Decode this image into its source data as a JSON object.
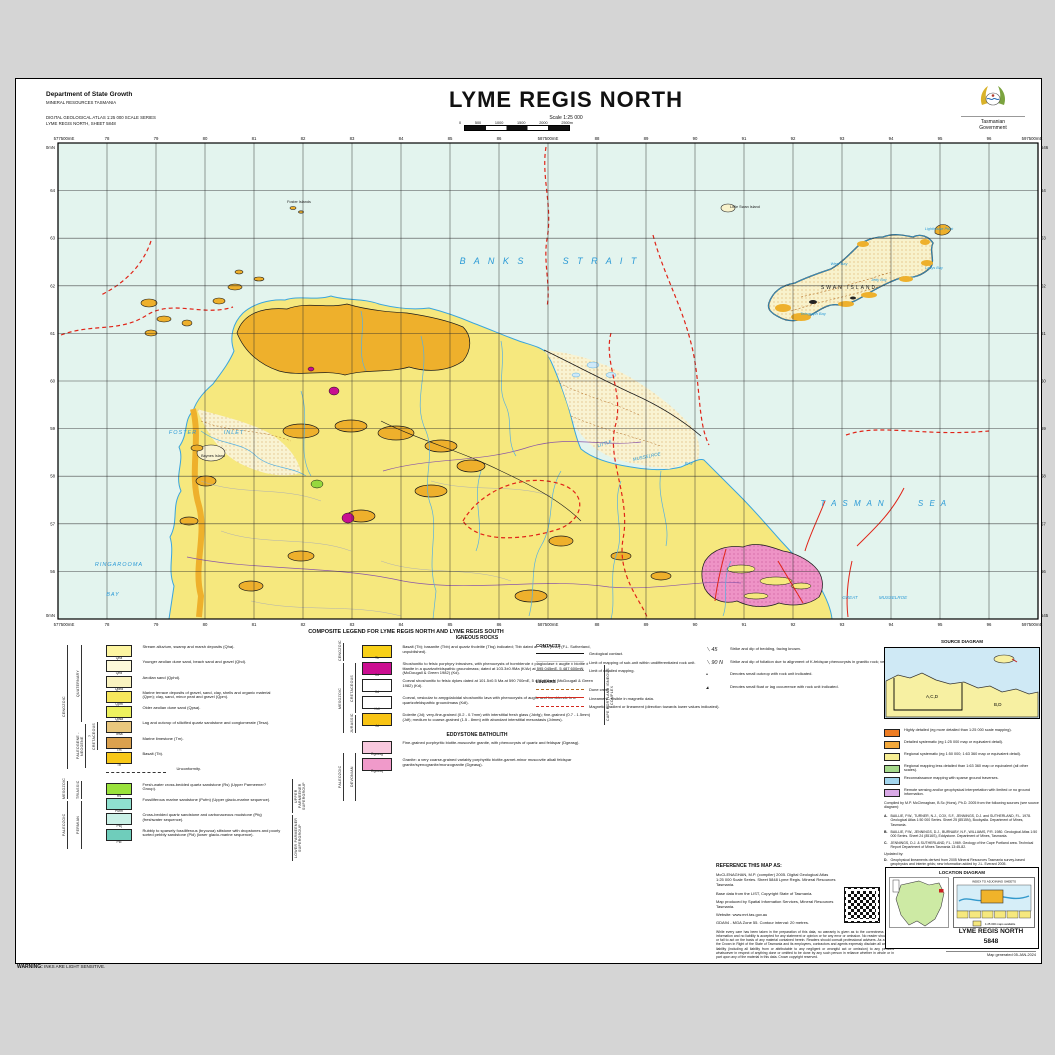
{
  "header": {
    "department": "Department of State Growth",
    "division": "MINERAL RESOURCES TASMANIA",
    "series_line1": "DIGITAL GEOLOGICAL ATLAS 1:25 000 SCALE SERIES",
    "series_line2": "LYME REGIS NORTH, SHEET 5848",
    "title": "LYME REGIS NORTH",
    "scale_label": "Scale 1:25 000",
    "scalebar_ticks": [
      "0",
      "500",
      "1000",
      "1500",
      "2000",
      "2500m"
    ],
    "logo_line1": "Tasmanian",
    "logo_line2": "Government"
  },
  "map": {
    "grid": {
      "eastings_top": [
        "78",
        "79",
        "80",
        "81",
        "82",
        "83",
        "84",
        "85",
        "86",
        "587500mE",
        "88",
        "89",
        "90",
        "91",
        "92",
        "93",
        "94",
        "95",
        "96"
      ],
      "eastings_bottom": [
        "78",
        "79",
        "80",
        "81",
        "82",
        "83",
        "84",
        "85",
        "86",
        "587500mE",
        "88",
        "89",
        "90",
        "91",
        "92",
        "93",
        "94",
        "95",
        "96"
      ],
      "northings_left": [
        "64",
        "63",
        "62",
        "61",
        "60",
        "59",
        "58",
        "57",
        "56"
      ],
      "northings_right": [
        "64",
        "63",
        "62",
        "61",
        "60",
        "59",
        "58",
        "57",
        "56"
      ],
      "corner_tl_e": "577500mE",
      "corner_tr_e": "597500mE",
      "corner_bl_e": "577500mE",
      "corner_br_e": "597500mE",
      "corner_tl_n": "5465000mN",
      "corner_bl_n": "5455000mN",
      "corner_tr_n": "5465000mN",
      "corner_br_n": "5455000mN"
    },
    "sea_labels": [
      {
        "text": "B A N K S",
        "x": 492,
        "y": 263,
        "s": 9,
        "sp": 3
      },
      {
        "text": "S T R A I T",
        "x": 600,
        "y": 263,
        "s": 9,
        "sp": 3
      },
      {
        "text": "T A S M A N",
        "x": 852,
        "y": 505,
        "s": 8,
        "sp": 2
      },
      {
        "text": "S E A",
        "x": 932,
        "y": 505,
        "s": 8,
        "sp": 2
      },
      {
        "text": "FOSTER",
        "x": 182,
        "y": 433,
        "s": 5.5,
        "sp": 1
      },
      {
        "text": "INLET",
        "x": 233,
        "y": 433,
        "s": 5.5,
        "sp": 1
      },
      {
        "text": "RINGAROOMA",
        "x": 118,
        "y": 565,
        "s": 5.5,
        "sp": 1
      },
      {
        "text": "BAY",
        "x": 112,
        "y": 595,
        "s": 5.5,
        "sp": 1
      },
      {
        "text": "LITTLE",
        "x": 604,
        "y": 444,
        "s": 4.5,
        "r": -18
      },
      {
        "text": "MUSSELROE",
        "x": 646,
        "y": 457,
        "s": 4.5,
        "r": -12
      },
      {
        "text": "BAY",
        "x": 688,
        "y": 464,
        "s": 4.5
      },
      {
        "text": "GREAT",
        "x": 849,
        "y": 598,
        "s": 4.5
      },
      {
        "text": "MUSSELROE",
        "x": 892,
        "y": 598,
        "s": 4.5
      },
      {
        "text": "West Bay",
        "x": 838,
        "y": 264,
        "s": 4
      },
      {
        "text": "Telegraph Bay",
        "x": 812,
        "y": 314,
        "s": 4
      },
      {
        "text": "Lighthouse Point",
        "x": 938,
        "y": 229,
        "s": 3.8
      },
      {
        "text": "Ladys Bay",
        "x": 933,
        "y": 268,
        "s": 3.8
      },
      {
        "text": "Jetty Bay",
        "x": 878,
        "y": 280,
        "s": 3.8
      }
    ],
    "place_labels": [
      {
        "text": "SWAN ISLAND",
        "x": 848,
        "y": 288,
        "s": 5,
        "sp": 2
      },
      {
        "text": "Baynes Island",
        "x": 212,
        "y": 456,
        "s": 3.8
      },
      {
        "text": "Little Swan Island",
        "x": 744,
        "y": 207,
        "s": 3.8
      },
      {
        "text": "Foster Islands",
        "x": 298,
        "y": 202,
        "s": 3.8
      }
    ]
  },
  "legend": {
    "title": "COMPOSITE LEGEND FOR LYME REGIS NORTH AND LYME REGIS SOUTH",
    "eras": {
      "cenozoic": "CENOZOIC",
      "mesozoic": "MESOZOIC",
      "paleozoic": "PALEOZOIC",
      "quaternary": "QUATERNARY",
      "holocene": "HOLOCENE",
      "pleistocene": "PLEISTOCENE",
      "paleogene_neogene": "PALEOGENE - NEOGENE",
      "cretaceous_q": "?CRETACEOUS",
      "triassic": "TRIASSIC",
      "permian": "PERMIAN",
      "upper_parmeener": "UPPER PARMEENER SUPERGROUP",
      "lower_parmeener": "LOWER PARMEENER SUPERGROUP",
      "cretaceous": "CRETACEOUS",
      "jurassic": "JURASSIC",
      "devonian": "DEVONIAN",
      "cape_portland": "CAPE PORTLAND IGNEOUS COMPLEX"
    },
    "left_units": [
      {
        "code": "Qha",
        "color": "#fdf5a0",
        "label": "Stream alluvium, swamp and marsh deposits (Qha)."
      },
      {
        "code": "Qhd",
        "color": "#fdf9d9",
        "pattern": "dots-sand",
        "label": "Younger aeolian dune sand, beach sand and gravel (Qhd)."
      },
      {
        "code": "Qphd",
        "color": "#faf3c0",
        "pattern": "dots-sand",
        "label": "Aeolian sand (Qphd)."
      },
      {
        "code": "Qpm",
        "color": "#f7e75c",
        "label": "Marine terrace deposits of gravel, sand, clay, shells and organic material (Qpm); clay, sand, minor peat and gravel (Qpm)."
      },
      {
        "code": "Qpsa",
        "color": "#eef25e",
        "pattern": "dots-sand",
        "label": "Older aeolian dune sand (Qpsa)."
      },
      {
        "code": "Tesa",
        "color": "#e9c77d",
        "label": "Lag and outcrop of silicified quartz sandstone and conglomerate (Tesa)."
      },
      {
        "code": "Tm",
        "color": "#dba14e",
        "label": "Marine limestone (Tm)."
      },
      {
        "code": "Tb",
        "color": "#f8c818",
        "label": "Basalt (Tb)."
      },
      {
        "code": "",
        "pattern": "unconf",
        "label": "Unconformity."
      },
      {
        "code": "Rs",
        "color": "#9ae23c",
        "label": "Fresh-water cross-bedded quartz sandstone (Rs) (Upper Parmeener? Group)."
      },
      {
        "code": "Pufm",
        "color": "#8fe0cf",
        "label": "Fossiliferous marine sandstone (Pufm) (Upper glacio-marine sequence)."
      },
      {
        "code": "Pfq",
        "color": "#c9f0e6",
        "label": "Cross-bedded quartz sandstone and carbonaceous mudstone (Pfq) (freshwater sequence)."
      },
      {
        "code": "Pld",
        "color": "#6fcdbb",
        "label": "Rubbly to sparsely fossiliferous (bryozoa) siltstone with dropstones and poorly sorted pebbly sandstone (Pld) (lower glacio-marine sequence)."
      }
    ],
    "igneous_title": "IGNEOUS ROCKS",
    "igneous_units": [
      {
        "code": "Tb",
        "color": "#f8d018",
        "label": "Basalt (Tb); basanite (Tbb) and quartz tholeiite (Tbq) indicated; Tbb dated at ~1Ma (K/Ar) (F.L. Sutherland, unpublished)."
      },
      {
        "code": "Kd",
        "color": "#cb0e91",
        "label": "Shoshonitic to felsic porphyry intrusives, with phenocrysts of hornblende ± plagioclase ± augite ± biotite ± titanite in a quartzofeldspathic groundmass; dated at 103.3±0.9Ma (K/Ar) at 595 045mE, 5 487 600mN (McDougall & Green 1982) (Kd)."
      },
      {
        "code": "Kd",
        "color": "#ffffff",
        "pattern": "stripes-mag",
        "label": "Coeval shoshonitic to felsic dykes dated at 101.5±0.5 Ma at 590 700mE, 5 487 400mN (McDougall & Green 1982) (Kd)."
      },
      {
        "code": "Kdl",
        "color": "#ffffff",
        "pattern": "stripes-pink",
        "label": "Coeval, vesicular to amygdaloidal shoshonitic lava with phenocrysts of augite and hornblende in a quartzofeldspathic groundmass (Kdl)."
      },
      {
        "code": "Jd",
        "color": "#f8c414",
        "label": "Dolerite (Jd); very-fine-grained (0.2 - 0.7mm) with interstitial fresh glass (Jdvfg); fine-grained (0.7 - 1.5mm) (Jdf); medium to coarse-grained (1.5 - 8mm) with abundant interstitial mesostasis (Jdmes)."
      }
    ],
    "batholith_title": "EDDYSTONE BATHOLITH",
    "batholith_units": [
      {
        "code": "Dgeasg",
        "color": "#f8c8de",
        "pattern": "dots-pink",
        "label": "Fine-grained porphyritic biotite-muscovite granite, with phenocrysts of quartz and feldspar (Dgeasg)."
      },
      {
        "code": "Dgeasq",
        "color": "#f09aca",
        "pattern": "dots-pink",
        "label": "Granite: a very coarse-grained variably porphyritic biotite-garnet-minor muscovite alkali feldspar granite/syenogranite/monzogranite (Dgeasq)."
      }
    ],
    "contacts_title": "CONTACTS",
    "contacts": [
      {
        "style": "ls-contact",
        "label": "Geological contact."
      },
      {
        "style": "ls-limit",
        "label": "Limit of mapping of sub-unit within undifferentiated rock unit."
      },
      {
        "style": "ls-detail",
        "label": "Limit of detailed mapping."
      }
    ],
    "linears_title": "LINEARS",
    "linears": [
      {
        "style": "ls-dune",
        "label": "Dune crest."
      },
      {
        "style": "ls-mag",
        "label": "Lineament - visible in magnetic data."
      },
      {
        "style": "ls-maggrad",
        "label": "Magnetic gradient or lineament (direction towards lower values indicated)."
      }
    ],
    "symbols": [
      {
        "glyph": "⟍ 45",
        "label": "Strike and dip of bedding, facing known."
      },
      {
        "glyph": "⟍ 90 N",
        "label": "Strike and dip of foliation due to alignment of K-feldspar phenocrysts in granitic rock; vertical."
      },
      {
        "glyph": "•",
        "label": "Denotes small outcrop with rock unit indicated."
      },
      {
        "glyph": "▴",
        "label": "Denotes small float or lag occurrence with rock unit indicated."
      }
    ]
  },
  "source_diagram": {
    "title": "SOURCE DIAGRAM",
    "region_a": "A,C,D",
    "region_b": "B,D",
    "legend": [
      {
        "color": "#ee7d23",
        "label": "Highly detailed (eg more detailed than 1:25 000 scale mapping)."
      },
      {
        "color": "#f3a93c",
        "label": "Detailed systematic (eg 1:25 000 map or equivalent detail)."
      },
      {
        "color": "#f7ee93",
        "label": "Regional systematic (eg 1:50 000; 1:63 360 map or equivalent detail)."
      },
      {
        "color": "#a5d98b",
        "label": "Regional mapping less detailed than 1:63 360 map or equivalent (all other scales)."
      },
      {
        "color": "#a3d6ee",
        "label": "Reconnaissance mapping with sparse ground traverses."
      },
      {
        "color": "#d9a9e6",
        "label": "Remote sensing and/or geophysical interpretation with limited or no ground information."
      }
    ],
    "compiled": "Compiled by M.P. McClenaghan, B.Sc (Hons), Ph.D. 2005 from the following sources (see source diagram):",
    "sources": [
      {
        "id": "A.",
        "text": "BAILLIE, P.W., TURNER, N.J., COX, S.F., JENNINGS, D.J. and SUTHERLAND, F.L. 1978. Geological Atlas 1:50 000 Series. Sheet 25 (8515N), Boobyalla. Department of Mines, Tasmania."
      },
      {
        "id": "B.",
        "text": "BAILLIE, P.W., JENNINGS, D.J., BURNABY, N.F., WILLIAMS, P.R. 1980. Geological Atlas 1:50 000 Series. Sheet 24 (8516S), Eddystone. Department of Mines, Tasmania."
      },
      {
        "id": "C.",
        "text": "JENNINGS, D.J. & SUTHERLAND, F.L. 1969. Geology of the Cape Portland area. Technical Report Department of Mines Tasmania 13:45-82."
      }
    ],
    "updated_label": "Updated by:",
    "updated": [
      {
        "id": "D.",
        "text": "Geophysical lineaments derived from 2005 Mineral Resources Tasmania survey-based geophysics and interim grids; new information added by J.L. Everard 2005."
      }
    ]
  },
  "reference": {
    "heading": "REFERENCE THIS MAP AS:",
    "citation": "McCLENAGHAN, M.P. (compiler) 2005. Digital Geological Atlas 1:25 000 Scale Series. Sheet 5848 Lyme Regis. Mineral Resources Tasmania.",
    "base": "Base data from the LIST, Copyright State of Tasmania.",
    "produced": "Map produced by Spatial Information Services, Mineral Resources Tasmania.",
    "website": "Website: www.mrt.tas.gov.au",
    "datum": "GDA94 - MGA Zone 55. Contour interval: 20 metres.",
    "disclaimer": "While every care has been taken in the preparation of this data, no warranty is given as to the correctness of the information and no liability is accepted for any statement or opinion or for any error or omission. No reader should act or fail to act on the basis of any material contained herein. Readers should consult professional advisers. As a result the Crown in Right of the State of Tasmania and its employees, contractors and agents expressly disclaim all and any liability (including all liability from or attributable to any negligent or wrongful act or omission) to any persons whatsoever in respect of anything done or omitted to be done by any such person in reliance whether in whole or in part upon any of the material in this data. Crown copyright reserved."
  },
  "location_diagram": {
    "title": "LOCATION DIAGRAM",
    "index_title": "INDEX TO ADJOINING SHEETS",
    "note": "1:25 000 maps available",
    "sheet_name": "LYME REGIS NORTH",
    "sheet_number": "5848"
  },
  "footer": {
    "warning_label": "WARNING:",
    "warning_text": "INKS ARE LIGHT SENSITIVE.",
    "generated": "Map generated 05-JAN-2024"
  }
}
